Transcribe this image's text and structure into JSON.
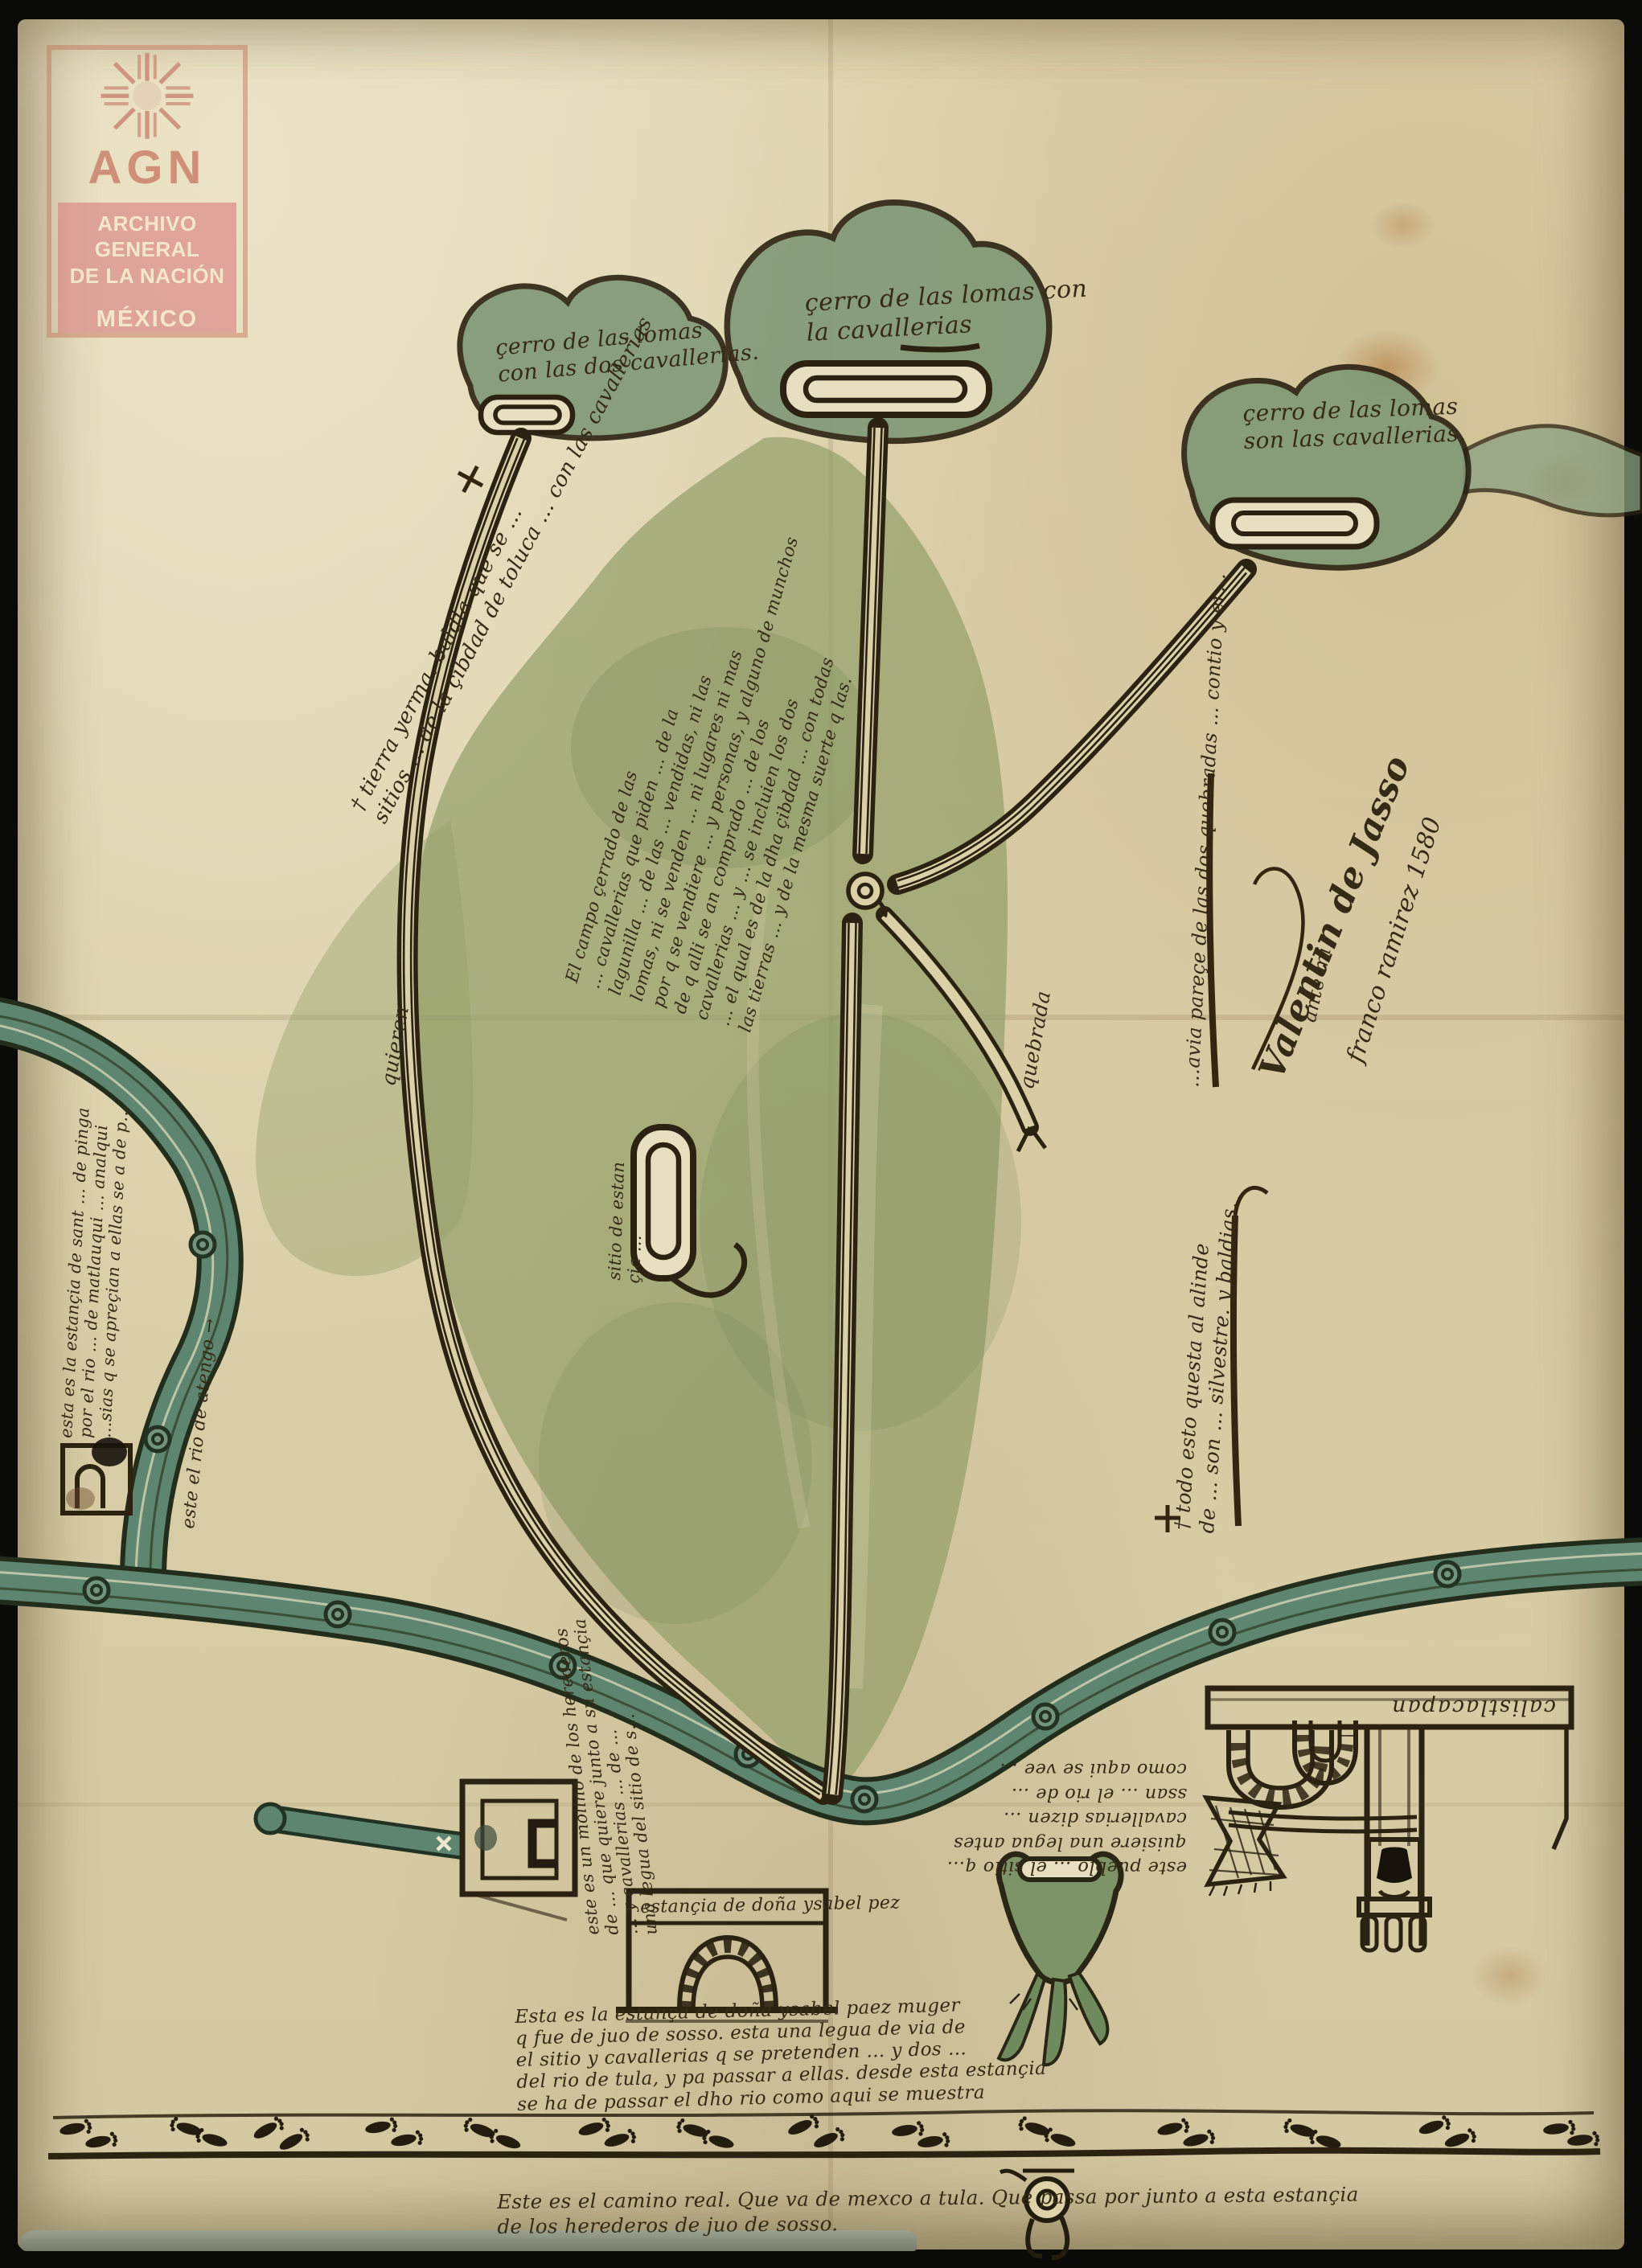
{
  "stamp": {
    "acronym": "AGN",
    "org_line1": "ARCHIVO GENERAL",
    "org_line2": "DE LA NACIÓN",
    "country": "MÉXICO"
  },
  "palette": {
    "paper": "#ddd1ab",
    "ink": "#2b2212",
    "hill_green": "#7f9876",
    "valley_green": "#93a06a",
    "river_teal": "#5d8570",
    "stamp_pink": "#d98f8f",
    "stamp_red": "#c97f6b"
  },
  "annotations": {
    "hill_left": {
      "l1": "çerro de las lomas",
      "l2": "con las dos cavallerias."
    },
    "hill_center": {
      "l1": "çerro de las lomas con",
      "l2": "la cavallerias"
    },
    "hill_right": {
      "l1": "çerro de las lomas",
      "l2": "son las cavallerias."
    },
    "tierra": {
      "l1": "† tierra yerma. baldia que se …",
      "l2": "sitios … de la çibdad de toluca … con las cavallerias"
    },
    "quieren": "quieren",
    "campo": {
      "l1": "El campo çerrado de las",
      "l2": "… cavallerias que piden … de la",
      "l3": "lagunilla … de las … vendidas, ni las",
      "l4": "lomas, ni se venden … ni lugares ni mas",
      "l5": "por q se vendiere … y personas, y alguno de munchos",
      "l6": "de q alli se an comprado … de los",
      "l7": "cavallerias … y … se incluien los dos",
      "l8": "… el qual es de la dha çibdad … con todas",
      "l9": "las tierras … y de la mesma suerte q las."
    },
    "quebrada": "quebrada",
    "sitio": {
      "l1": "sitio de estan",
      "l2": "çia …"
    },
    "right_upper": "…avia pareçe de las dos quebradas … contio y er…",
    "sig_main": "Valentin de Jasso",
    "sig_ante": "ante mi",
    "sig_second": "franco ramirez 1580",
    "right_lower": {
      "l1": "† todo esto questa al alinde",
      "l2": "de … son … silvestre. y baldias."
    },
    "estancia_left": {
      "l1": "esta es la estançia de sant … de pinga",
      "l2": "por el rio … de matlauqui … analqui",
      "l3": "…sias q se apreçian a ellas se a de p…"
    },
    "rio": "este el rio de atengo →",
    "molino": {
      "l1": "este es un molino de los herederos",
      "l2": "de … que quiere junto a su estançia",
      "l3": "… y cavallerias … de …",
      "l4": "una legua del sitio de s…"
    },
    "venta_caption": "estançia de doña ysabel pez",
    "venta": {
      "l1": "Esta es la estança de doña ysabel paez muger",
      "l2": "q fue de juo de sosso. esta una legua de via de",
      "l3": "el sitio y cavallerias q se pretenden … y dos …",
      "l4": "del rio de tula, y pa passar a ellas. desde esta estançia",
      "l5": "se ha de passar el dho rio como aqui se muestra"
    },
    "pueblo": {
      "l1": "este pueblo … el sitio q…",
      "l2": "quisiere una legua antes",
      "l3": "cavallerias dizen …",
      "l4": "ssan … el rio de …",
      "l5": "como aqui se vee …"
    },
    "band": "calistlacapan",
    "camino": {
      "l1": "Este es el camino real. Que va de mexco a tula. Que passa por junto a esta estançia",
      "l2": "de los herederos de juo de sosso."
    }
  }
}
